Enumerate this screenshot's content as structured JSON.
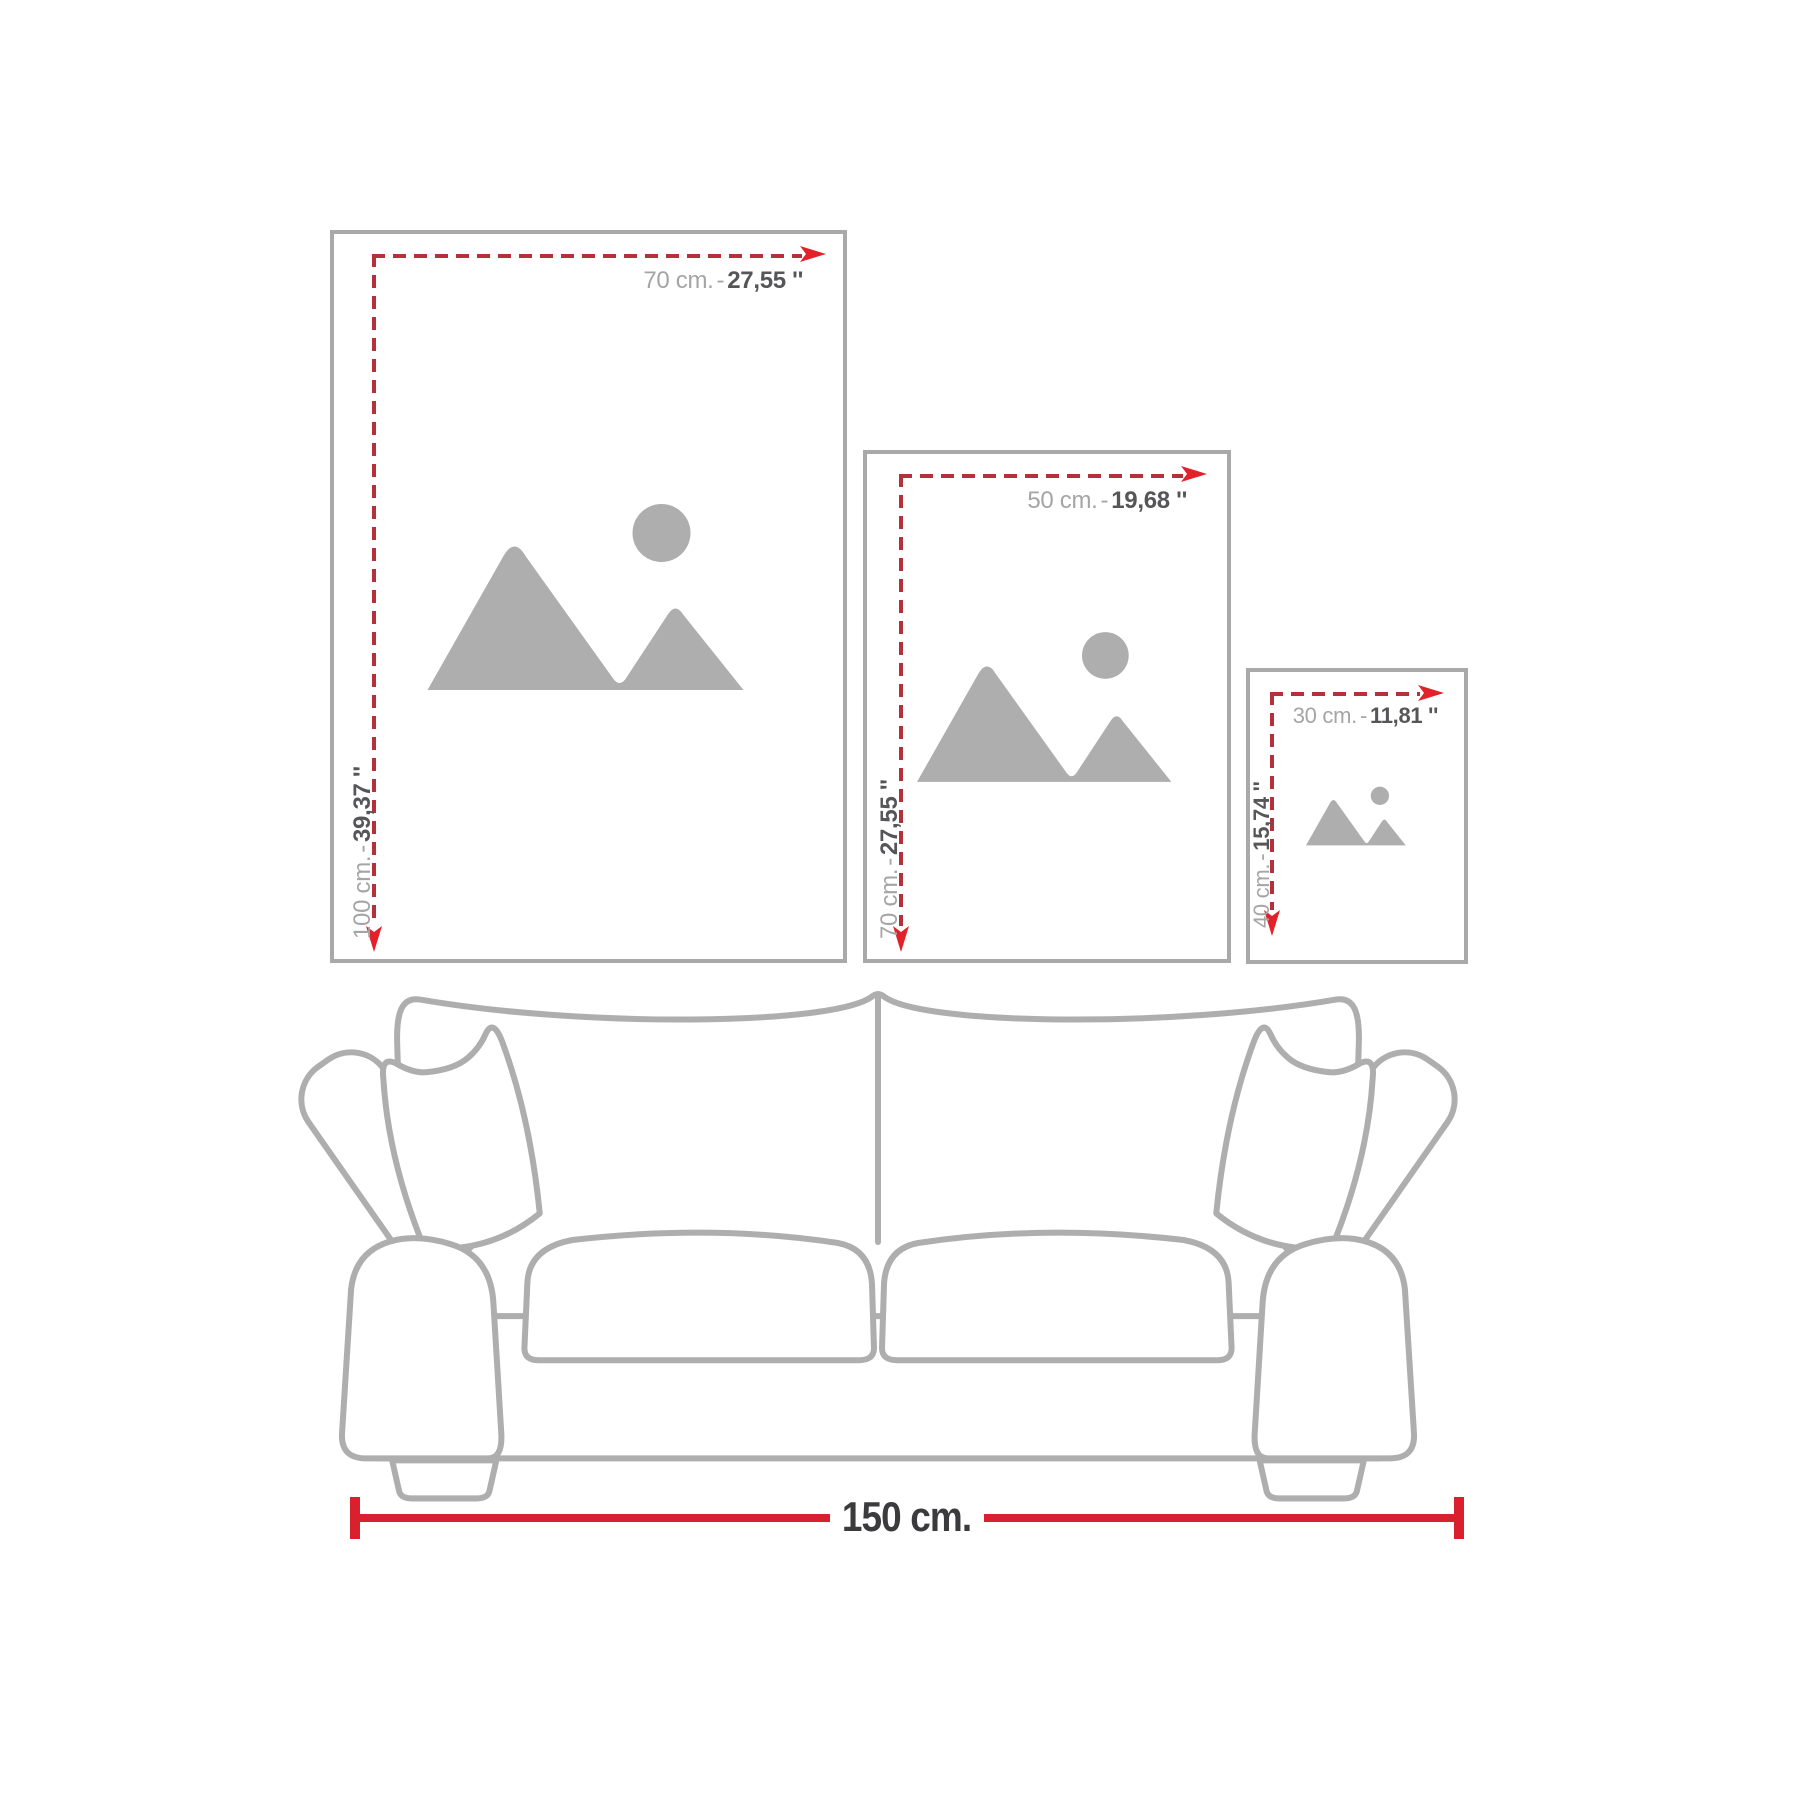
{
  "separator": "-",
  "frames": [
    {
      "width_cm": "70 cm.",
      "width_in": "27,55 ''",
      "height_cm": "100 cm.",
      "height_in": "39,37 ''"
    },
    {
      "width_cm": "50 cm.",
      "width_in": "19,68 ''",
      "height_cm": "70 cm.",
      "height_in": "27,55 ''"
    },
    {
      "width_cm": "30 cm.",
      "width_in": "11,81 ''",
      "height_cm": "40 cm.",
      "height_in": "15,74 ''"
    }
  ],
  "sofa": {
    "width_label": "150 cm."
  },
  "colors": {
    "frame_border": "#a9a9a9",
    "placeholder": "#aeaeae",
    "dash_red": "#b5303a",
    "arrow_red": "#e3212b",
    "label_gray": "#a5a5a7",
    "label_dark": "#565659",
    "sofa_line": "#aeaeae",
    "dim_red": "#d8202e",
    "dim_text": "#3b3b3d"
  }
}
